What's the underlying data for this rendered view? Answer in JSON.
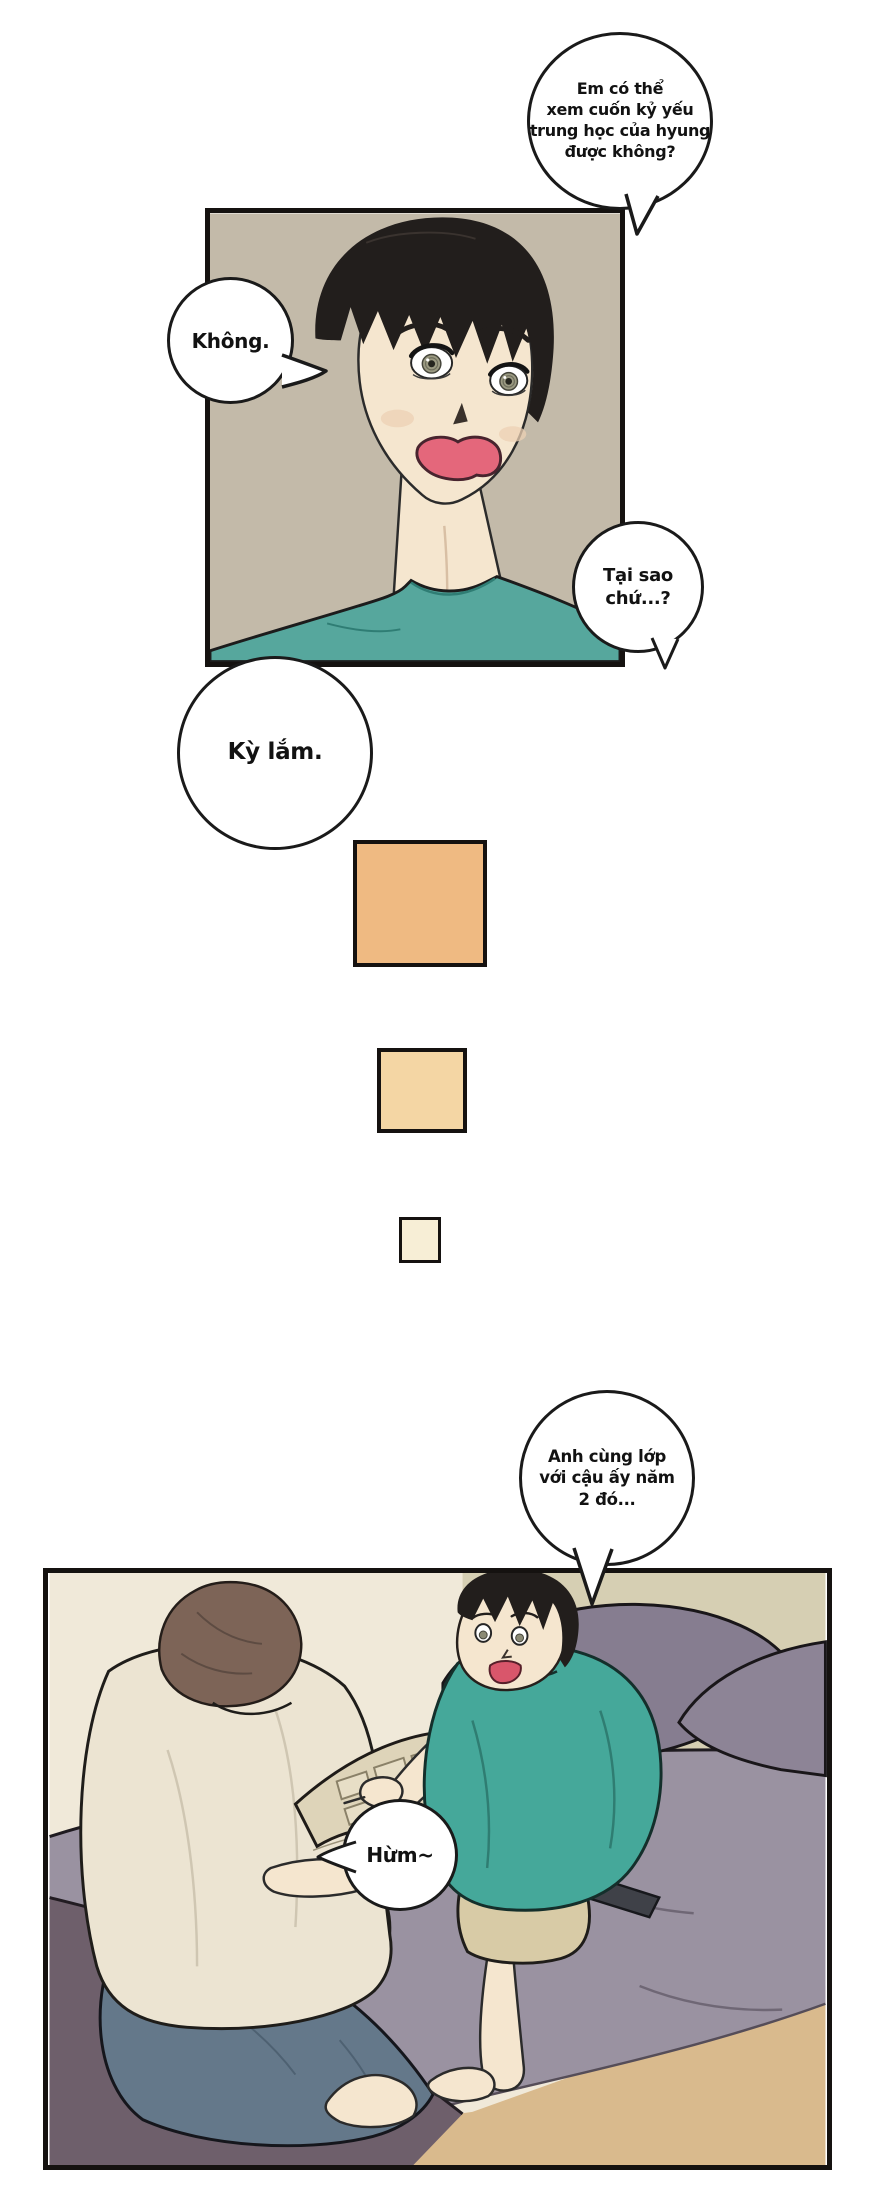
{
  "page_type": "comic-page",
  "bubbles": [
    {
      "id": "b1",
      "text": "Em có thể xem cuốn kỷ yếu trung học của hyung được không?",
      "lines": [
        "Em có thể",
        "xem cuốn kỷ yếu",
        "trung học của hyung",
        "được không?"
      ]
    },
    {
      "id": "b2",
      "text": "Không.",
      "lines": [
        "Không."
      ]
    },
    {
      "id": "b3",
      "text": "Tại sao chứ...?",
      "lines": [
        "Tại sao",
        "chứ...?"
      ]
    },
    {
      "id": "b4",
      "text": "Kỳ lắm.",
      "lines": [
        "Kỳ lắm."
      ]
    },
    {
      "id": "b5",
      "text": "Anh cùng lớp với cậu ấy năm 2 đó...",
      "lines": [
        "Anh cùng lớp",
        "với cậu ấy năm",
        "2 đó..."
      ]
    },
    {
      "id": "b6",
      "text": "Hừm~",
      "lines": [
        "Hừm~"
      ]
    }
  ],
  "transition_squares": [
    {
      "color": "#efba82"
    },
    {
      "color": "#f4d6a4"
    },
    {
      "color": "#f7eed6"
    }
  ],
  "palette": {
    "panel1_bg": "#c3baa9",
    "skin": "#f5e6cf",
    "hair_black": "#221e1c",
    "mouth_red": "#e4677b",
    "teal_shirt": "#56a79d",
    "wall_left": "#f0e9d9",
    "wall_right": "#d6cfb3",
    "bed_top": "#9a92a1",
    "bed_side": "#6e5f6b",
    "pillow": "#867d90",
    "floor": "#d9ba8d",
    "jeans": "#64788a",
    "tee_beige": "#ece4d2",
    "hair_brown": "#7d6457",
    "shorts_khaki": "#d8cba6",
    "yearbook_page": "#ded4b9",
    "outline": "#1a1a1a"
  }
}
